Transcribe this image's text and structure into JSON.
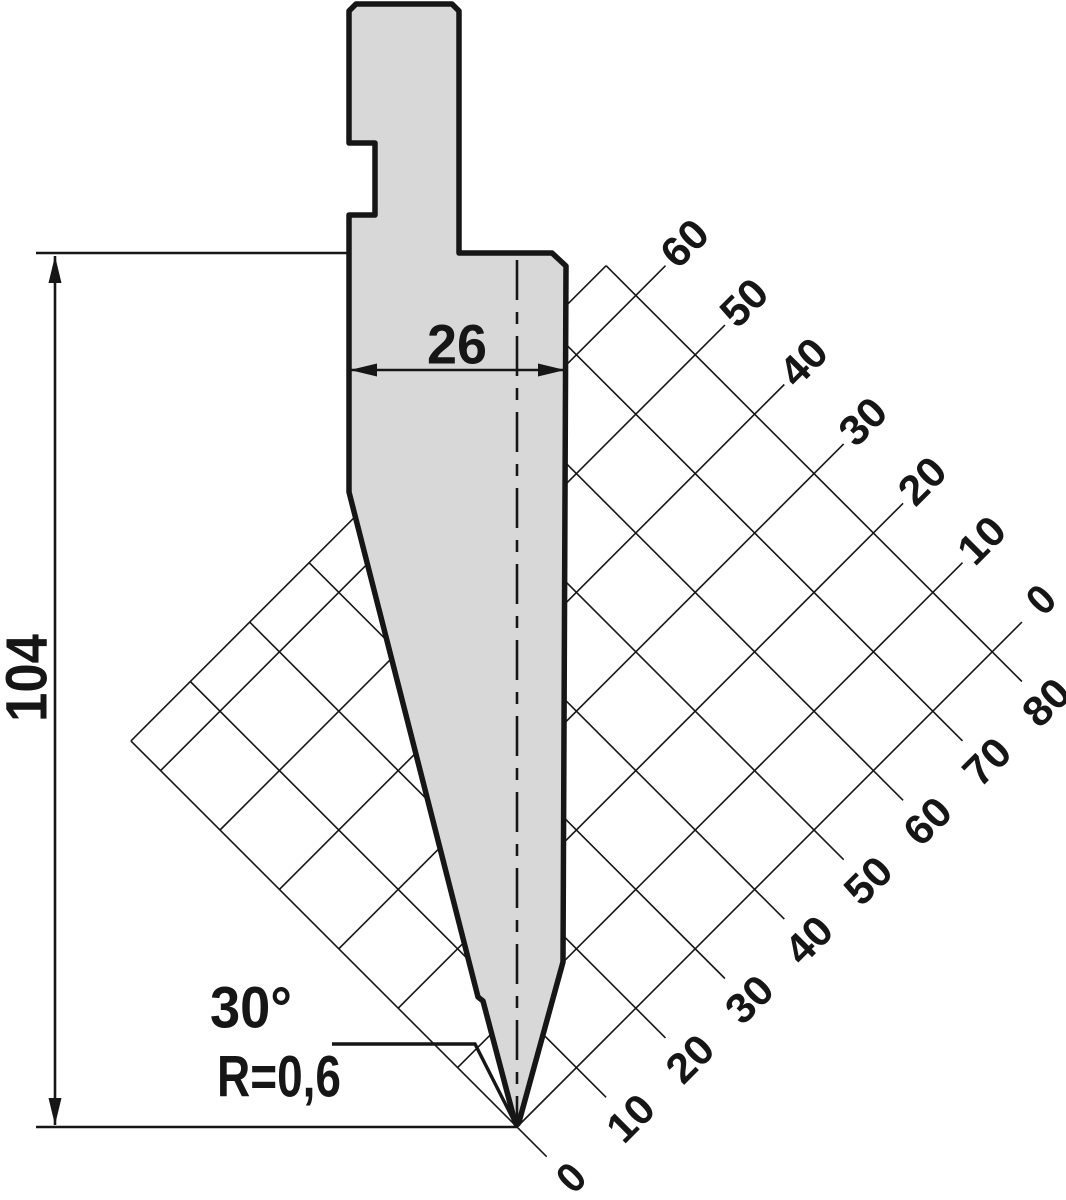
{
  "drawing": {
    "type": "press-brake-punch-technical-drawing",
    "dimensions": {
      "width_label": "26",
      "height_label": "104",
      "angle_label": "30°",
      "radius_label": "R=0,6"
    },
    "grid": {
      "upper_axis_labels": [
        "60",
        "50",
        "40",
        "30",
        "20",
        "10",
        "0"
      ],
      "lower_axis_labels": [
        "0",
        "10",
        "20",
        "30",
        "40",
        "50",
        "60",
        "70",
        "80"
      ],
      "unit_step": 10
    },
    "colors": {
      "punch_fill": "#d8d8d8",
      "line": "#161616"
    }
  }
}
